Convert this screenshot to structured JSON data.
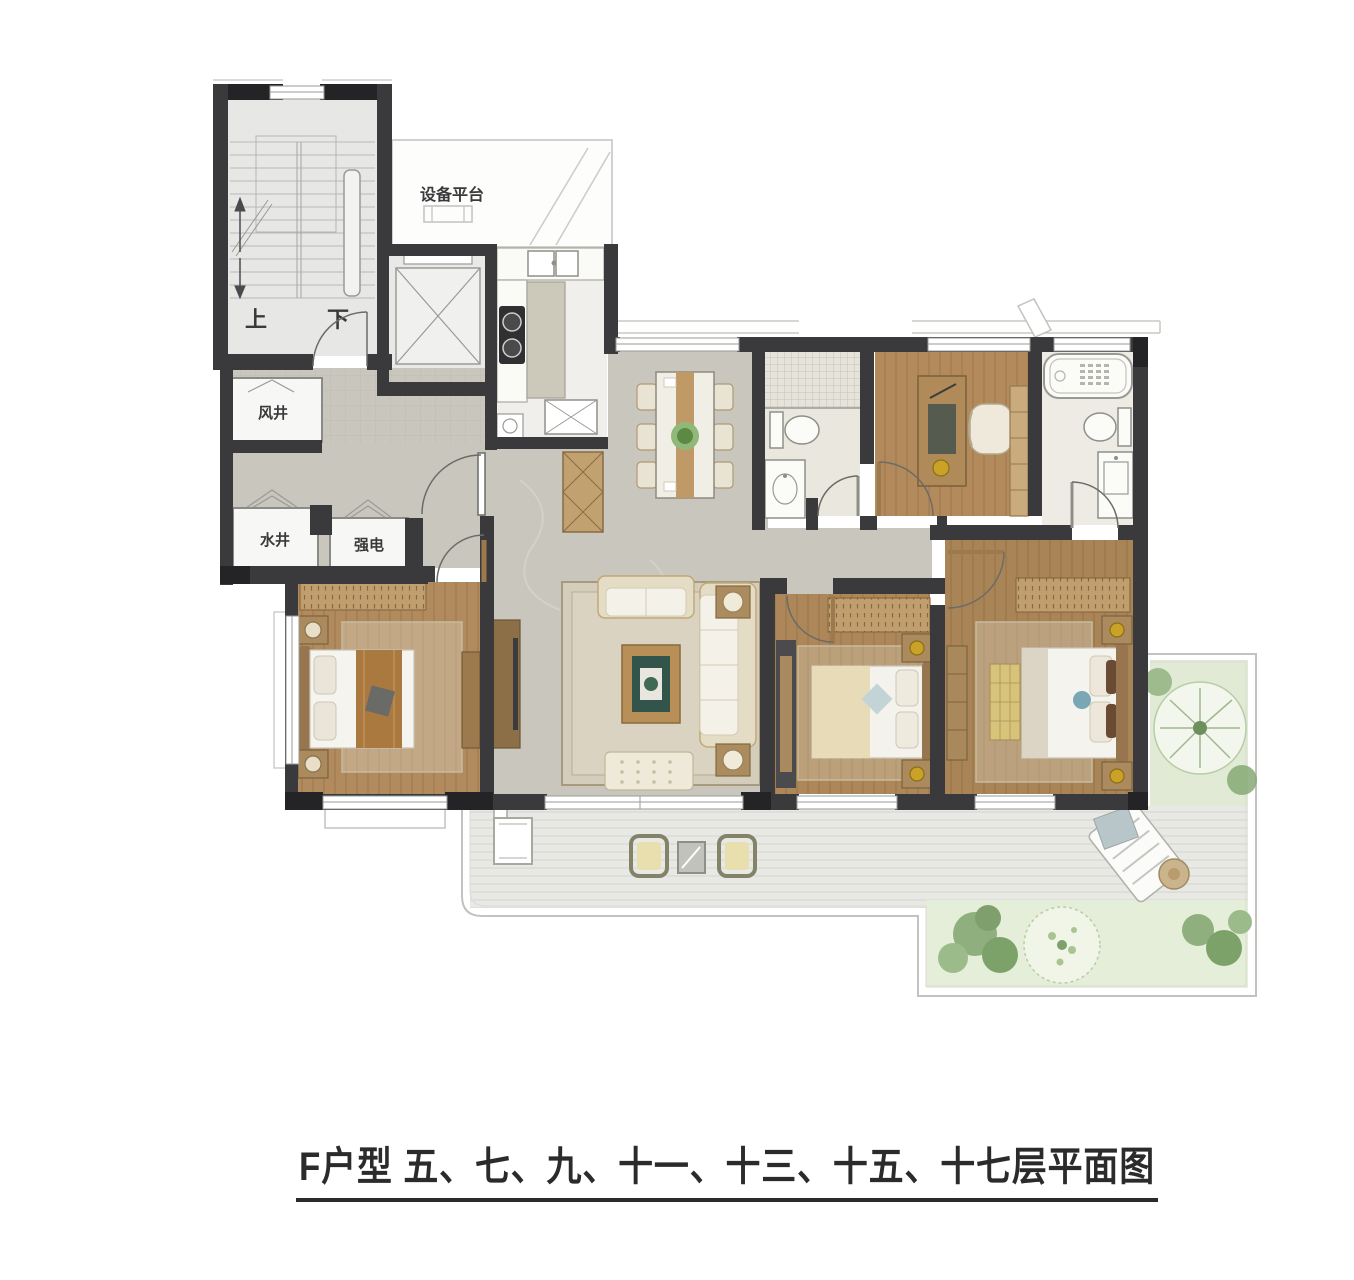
{
  "caption": {
    "text": "F户型 五、七、九、十一、十三、十五、十七层平面图"
  },
  "labels": {
    "equipment_platform": "设备平台",
    "air_shaft": "风井",
    "water_shaft": "水井",
    "electric_meter": "强电",
    "stair_up": "上",
    "stair_down": "下"
  },
  "colors": {
    "wall": "#3a3a3c",
    "wall_cap": "#242426",
    "marble_floor": "#c9c6bd",
    "wood_floor": "#b28a5c",
    "tile_white": "#efeee9",
    "deck": "#e8e8e4",
    "garden": "#e0ead4",
    "rug": "#d8cdb4",
    "gold_accent": "#c9a227",
    "text": "#2b2b2b"
  }
}
